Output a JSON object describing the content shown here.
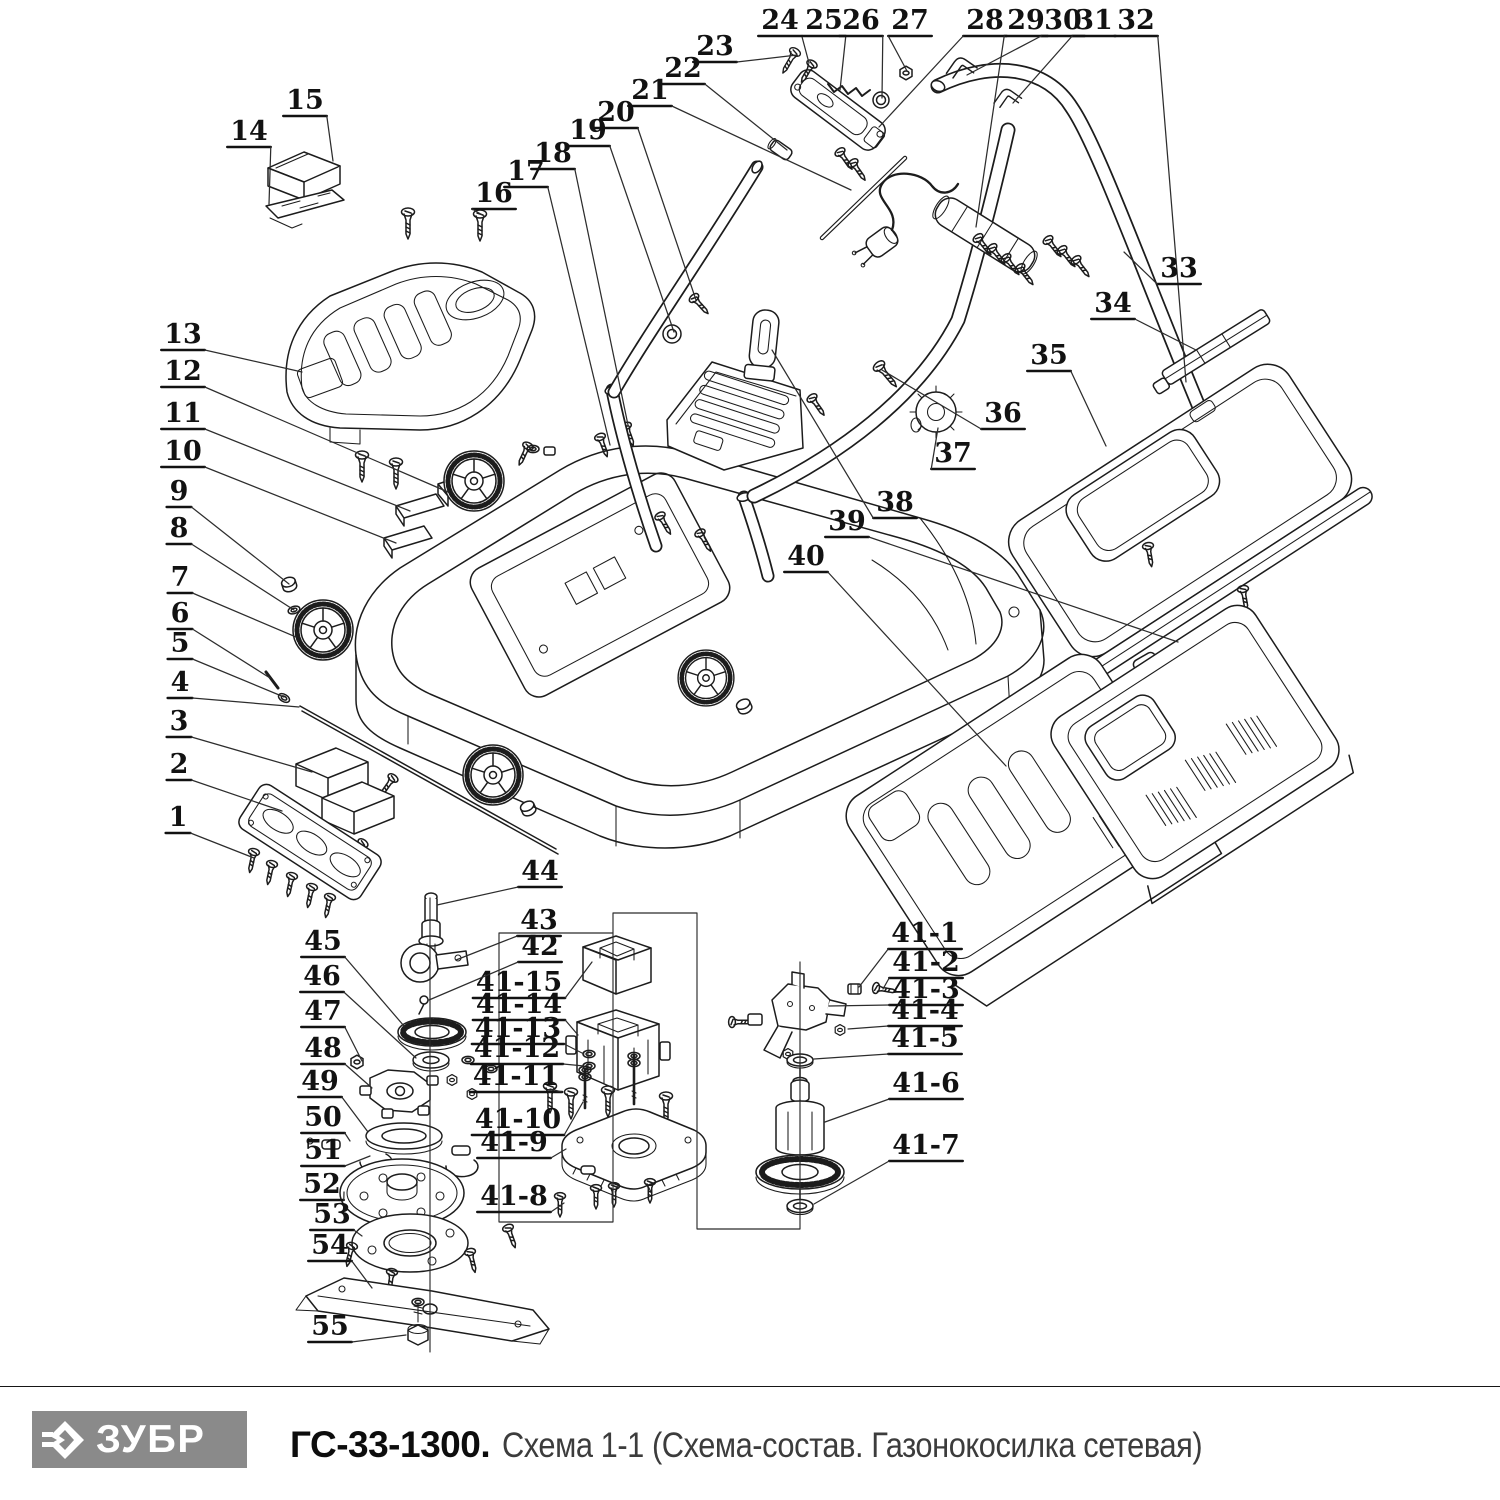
{
  "footer": {
    "brand": "ЗУБР",
    "model": "ГС-33-1300.",
    "subtitle": "Схема 1-1 (Схема-состав. Газонокосилка сетевая)",
    "logo_bg": "#8a8a8a",
    "logo_text_color": "#ffffff"
  },
  "diagram": {
    "stroke_color": "#1c1c1c",
    "label_color": "#121212",
    "labels": [
      {
        "n": "1",
        "x": 178,
        "y": 817,
        "tx": 254,
        "ty": 858
      },
      {
        "n": "2",
        "x": 179,
        "y": 764,
        "tx": 282,
        "ty": 811
      },
      {
        "n": "3",
        "x": 179,
        "y": 721,
        "tx": 312,
        "ty": 772
      },
      {
        "n": "4",
        "x": 180,
        "y": 682,
        "tx": 299,
        "ty": 707
      },
      {
        "n": "5",
        "x": 180,
        "y": 643,
        "tx": 284,
        "ty": 697
      },
      {
        "n": "6",
        "x": 180,
        "y": 613,
        "tx": 270,
        "ty": 678
      },
      {
        "n": "7",
        "x": 180,
        "y": 577,
        "tx": 296,
        "ty": 637
      },
      {
        "n": "8",
        "x": 179,
        "y": 528,
        "tx": 294,
        "ty": 610
      },
      {
        "n": "9",
        "x": 179,
        "y": 491,
        "tx": 289,
        "ty": 584
      },
      {
        "n": "10",
        "x": 183,
        "y": 451,
        "tx": 396,
        "ty": 543
      },
      {
        "n": "11",
        "x": 183,
        "y": 413,
        "tx": 410,
        "ty": 511
      },
      {
        "n": "12",
        "x": 183,
        "y": 371,
        "tx": 448,
        "ty": 492
      },
      {
        "n": "13",
        "x": 183,
        "y": 334,
        "tx": 302,
        "ty": 372
      },
      {
        "n": "14",
        "x": 249,
        "y": 131,
        "tx": 269,
        "ty": 204
      },
      {
        "n": "15",
        "x": 305,
        "y": 100,
        "tx": 333,
        "ty": 161
      },
      {
        "n": "16",
        "x": 494,
        "y": 193,
        "tx": 484,
        "ty": 216
      },
      {
        "n": "17",
        "x": 526,
        "y": 171,
        "tx": 610,
        "ty": 445
      },
      {
        "n": "18",
        "x": 553,
        "y": 153,
        "tx": 628,
        "ty": 425
      },
      {
        "n": "19",
        "x": 588,
        "y": 130,
        "tx": 674,
        "ty": 332
      },
      {
        "n": "20",
        "x": 616,
        "y": 112,
        "tx": 696,
        "ty": 300
      },
      {
        "n": "21",
        "x": 650,
        "y": 90,
        "tx": 851,
        "ty": 190
      },
      {
        "n": "22",
        "x": 683,
        "y": 68,
        "tx": 787,
        "ty": 150
      },
      {
        "n": "23",
        "x": 715,
        "y": 46,
        "tx": 797,
        "ty": 55
      },
      {
        "n": "24",
        "x": 780,
        "y": 20,
        "tx": 809,
        "ty": 63
      },
      {
        "n": "25",
        "x": 824,
        "y": 20,
        "tx": 840,
        "ty": 90
      },
      {
        "n": "26",
        "x": 861,
        "y": 20,
        "tx": 882,
        "ty": 98
      },
      {
        "n": "27",
        "x": 910,
        "y": 20,
        "tx": 907,
        "ty": 71
      },
      {
        "n": "28",
        "x": 985,
        "y": 20,
        "tx": 879,
        "ty": 127
      },
      {
        "n": "29",
        "x": 1026,
        "y": 20,
        "tx": 976,
        "ty": 227
      },
      {
        "n": "30",
        "x": 1063,
        "y": 20,
        "tx": 967,
        "ty": 75
      },
      {
        "n": "31",
        "x": 1094,
        "y": 20,
        "tx": 1013,
        "ty": 103
      },
      {
        "n": "32",
        "x": 1136,
        "y": 20,
        "tx": 1186,
        "ty": 382
      },
      {
        "n": "33",
        "x": 1179,
        "y": 268,
        "tx": 1124,
        "ty": 252
      },
      {
        "n": "34",
        "x": 1113,
        "y": 303,
        "tx": 1196,
        "ty": 350
      },
      {
        "n": "35",
        "x": 1049,
        "y": 355,
        "tx": 1106,
        "ty": 446
      },
      {
        "n": "36",
        "x": 1003,
        "y": 413,
        "tx": 882,
        "ty": 370
      },
      {
        "n": "37",
        "x": 953,
        "y": 453,
        "tx": 938,
        "ty": 428
      },
      {
        "n": "38",
        "x": 895,
        "y": 502,
        "tx": 772,
        "ty": 350
      },
      {
        "n": "39",
        "x": 847,
        "y": 521,
        "tx": 1178,
        "ty": 642
      },
      {
        "n": "40",
        "x": 806,
        "y": 556,
        "tx": 1006,
        "ty": 766
      },
      {
        "n": "41-1",
        "x": 925,
        "y": 933,
        "tx": 859,
        "ty": 987
      },
      {
        "n": "41-2",
        "x": 926,
        "y": 962,
        "tx": 883,
        "ty": 989
      },
      {
        "n": "41-3",
        "x": 926,
        "y": 989,
        "tx": 829,
        "ty": 1006
      },
      {
        "n": "41-4",
        "x": 925,
        "y": 1010,
        "tx": 848,
        "ty": 1029
      },
      {
        "n": "41-5",
        "x": 925,
        "y": 1038,
        "tx": 814,
        "ty": 1059
      },
      {
        "n": "41-6",
        "x": 926,
        "y": 1083,
        "tx": 825,
        "ty": 1122
      },
      {
        "n": "41-7",
        "x": 926,
        "y": 1145,
        "tx": 814,
        "ty": 1204
      },
      {
        "n": "41-8",
        "x": 514,
        "y": 1196,
        "tx": 564,
        "ty": 1203
      },
      {
        "n": "41-9",
        "x": 514,
        "y": 1142,
        "tx": 566,
        "ty": 1149
      },
      {
        "n": "41-10",
        "x": 518,
        "y": 1119,
        "tx": 583,
        "ty": 1102
      },
      {
        "n": "41-11",
        "x": 516,
        "y": 1076,
        "tx": 550,
        "ty": 1089
      },
      {
        "n": "41-12",
        "x": 517,
        "y": 1048,
        "tx": 584,
        "ty": 1066
      },
      {
        "n": "41-13",
        "x": 518,
        "y": 1028,
        "tx": 584,
        "ty": 1054
      },
      {
        "n": "41-14",
        "x": 519,
        "y": 1004,
        "tx": 578,
        "ty": 1035
      },
      {
        "n": "41-15",
        "x": 519,
        "y": 982,
        "tx": 592,
        "ty": 962
      },
      {
        "n": "42",
        "x": 540,
        "y": 946,
        "tx": 429,
        "ty": 1000
      },
      {
        "n": "43",
        "x": 539,
        "y": 920,
        "tx": 456,
        "ty": 960
      },
      {
        "n": "44",
        "x": 540,
        "y": 871,
        "tx": 437,
        "ty": 905
      },
      {
        "n": "45",
        "x": 323,
        "y": 941,
        "tx": 404,
        "ty": 1026
      },
      {
        "n": "46",
        "x": 322,
        "y": 976,
        "tx": 416,
        "ty": 1058
      },
      {
        "n": "47",
        "x": 323,
        "y": 1011,
        "tx": 362,
        "ty": 1061
      },
      {
        "n": "48",
        "x": 323,
        "y": 1048,
        "tx": 372,
        "ty": 1088
      },
      {
        "n": "49",
        "x": 320,
        "y": 1081,
        "tx": 368,
        "ty": 1132
      },
      {
        "n": "50",
        "x": 323,
        "y": 1117,
        "tx": 350,
        "ty": 1141
      },
      {
        "n": "51",
        "x": 323,
        "y": 1150,
        "tx": 370,
        "ty": 1156
      },
      {
        "n": "52",
        "x": 322,
        "y": 1184,
        "tx": 344,
        "ty": 1192
      },
      {
        "n": "53",
        "x": 332,
        "y": 1214,
        "tx": 362,
        "ty": 1236
      },
      {
        "n": "54",
        "x": 330,
        "y": 1245,
        "tx": 372,
        "ty": 1288
      },
      {
        "n": "55",
        "x": 330,
        "y": 1326,
        "tx": 406,
        "ty": 1335
      }
    ]
  }
}
